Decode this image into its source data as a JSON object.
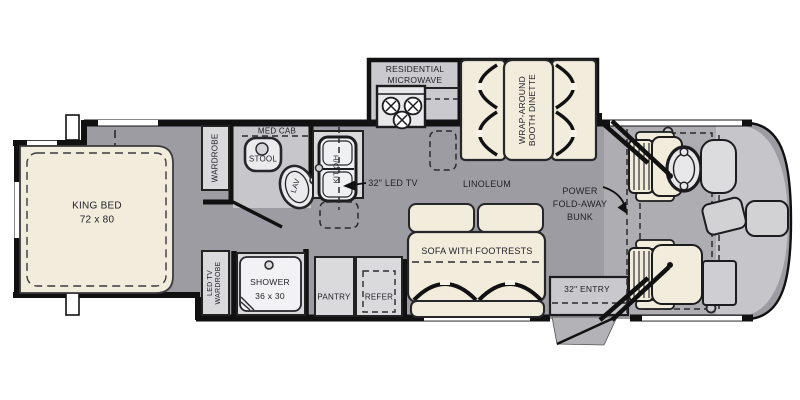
{
  "diagram_title": "Class A motorhome floor plan",
  "labels": {
    "king_bed_line1": "KING BED",
    "king_bed_line2": "72 x 80",
    "wardrobe_top": "WARDROBE",
    "med_cab": "MED CAB",
    "stool": "STOOL",
    "lav": "LAV",
    "kit_oh": "KIT O/H",
    "led_tv": "32\" LED TV",
    "microwave_line1": "RESIDENTIAL",
    "microwave_line2": "MICROWAVE",
    "dinette_line1": "WRAP-AROUND",
    "dinette_line2": "BOOTH DINETTE",
    "linoleum": "LINOLEUM",
    "bunk_line1": "POWER",
    "bunk_line2": "FOLD-AWAY",
    "bunk_line3": "BUNK",
    "sofa": "SOFA WITH FOOTRESTS",
    "led_tv_wardrobe_line1": "LED TV",
    "led_tv_wardrobe_line2": "WARDROBE",
    "shower_line1": "SHOWER",
    "shower_line2": "36 x 30",
    "pantry": "PANTRY",
    "refer": "REFER",
    "entry": "32\" ENTRY"
  },
  "colors": {
    "floor_gray": "#9c9ca2",
    "cab_gray": "#adadb2",
    "front_light_gray": "#c6c6ca",
    "slide_floor": "#cacace",
    "counter_gray": "#dadadd",
    "furniture_cream": "#f2ecdc",
    "fixture_white": "#ebebee",
    "wall_black": "#111111"
  }
}
